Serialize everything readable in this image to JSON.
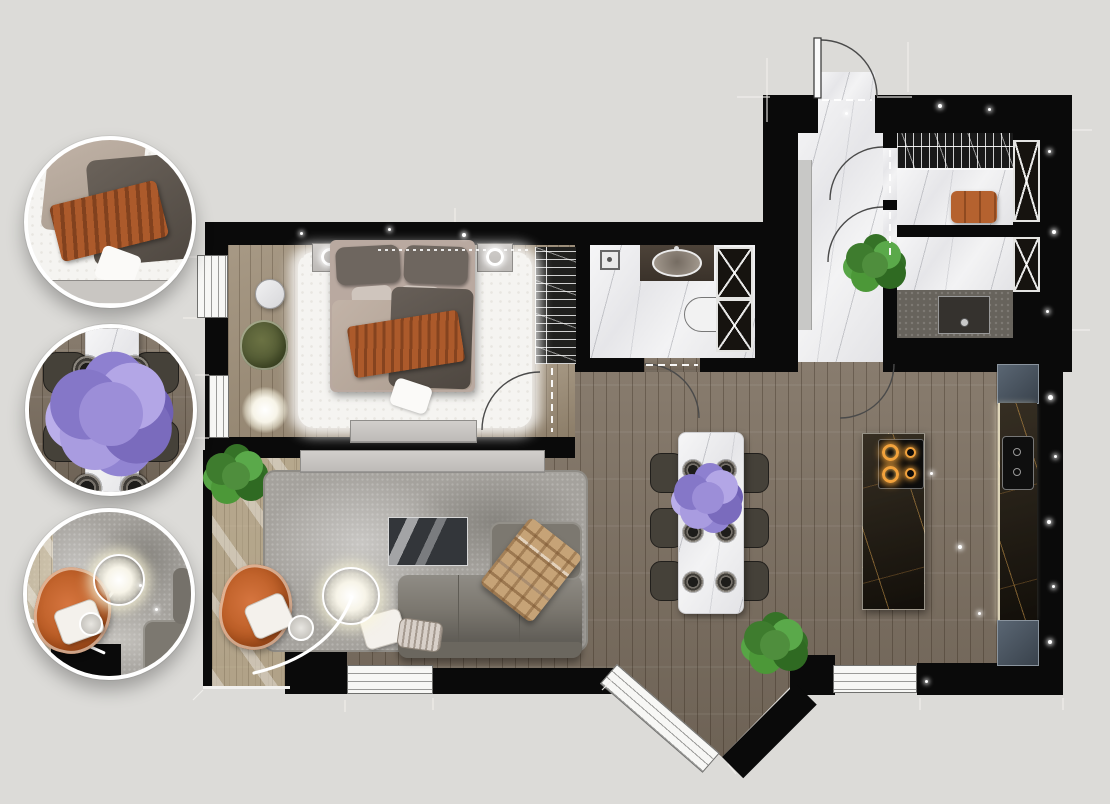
{
  "title": "apartment-interior-floor-plan-render",
  "colors": {
    "bg": "#dcdbd8",
    "wall": "#0a0a0a",
    "wood": "#7f7263",
    "woodbed": "#9b8b74",
    "marble": "#eeeef0",
    "darkmarble": "#1f1910",
    "goldvein": "#c08b45",
    "fur": "#f5f4f1",
    "rug": "#a5a29d",
    "sofa": "#7c7870",
    "console": "#cbc8c5",
    "orange": "#bb5f2e",
    "greenchair": "#5d6239",
    "plant": "#4f8e3d",
    "purple": "#9c8ed8",
    "plaid": "#c6a377",
    "cabinetblue": "#4d5864",
    "stone": "#67635c",
    "towel": "#b5622f",
    "glow": "#fff8e0"
  },
  "rooms": [
    {
      "name": "bedroom",
      "furniture": [
        "double-bed",
        "nightstand-left",
        "nightstand-right",
        "ring-lamp-left",
        "ring-lamp-right",
        "fur-rug",
        "green-armchair",
        "round-side-table",
        "floor-lamp-glow",
        "dresser",
        "built-in-wardrobe",
        "window-upper",
        "window-lower",
        "curtain"
      ]
    },
    {
      "name": "bathroom",
      "furniture": [
        "shower-head",
        "vanity-counter",
        "oval-sink",
        "toilet",
        "tall-x-cabinet",
        "door-swing"
      ]
    },
    {
      "name": "entry-hall",
      "furniture": [
        "entry-door",
        "hall-cabinet",
        "plant",
        "interior-door-1",
        "interior-door-2",
        "marble-floor"
      ]
    },
    {
      "name": "wardrobe-room",
      "furniture": [
        "hanger-rail",
        "folded-towels",
        "x-front-cabinet",
        "marble-floor"
      ]
    },
    {
      "name": "utility-room",
      "furniture": [
        "stone-counter",
        "utility-sink",
        "x-front-cabinet",
        "marble-floor"
      ]
    },
    {
      "name": "kitchen-dining",
      "furniture": [
        "dining-table",
        "dining-chairs-6",
        "plates-6",
        "lilac-bouquet",
        "kitchen-island",
        "induction-cooktop",
        "counter-column",
        "double-sink",
        "upper-cabinet",
        "lower-cabinet",
        "plant"
      ]
    },
    {
      "name": "living-room",
      "furniture": [
        "area-rug",
        "sofa",
        "chaise",
        "plaid-blanket",
        "pillows",
        "tv-console",
        "tv-panel",
        "orange-armchair",
        "arc-floor-lamp",
        "balcony-strip",
        "corner-plant",
        "window-bottom",
        "window-diagonal"
      ]
    }
  ],
  "callouts": [
    {
      "name": "bed-detail"
    },
    {
      "name": "dining-table-detail"
    },
    {
      "name": "lounge-chair-detail"
    }
  ]
}
